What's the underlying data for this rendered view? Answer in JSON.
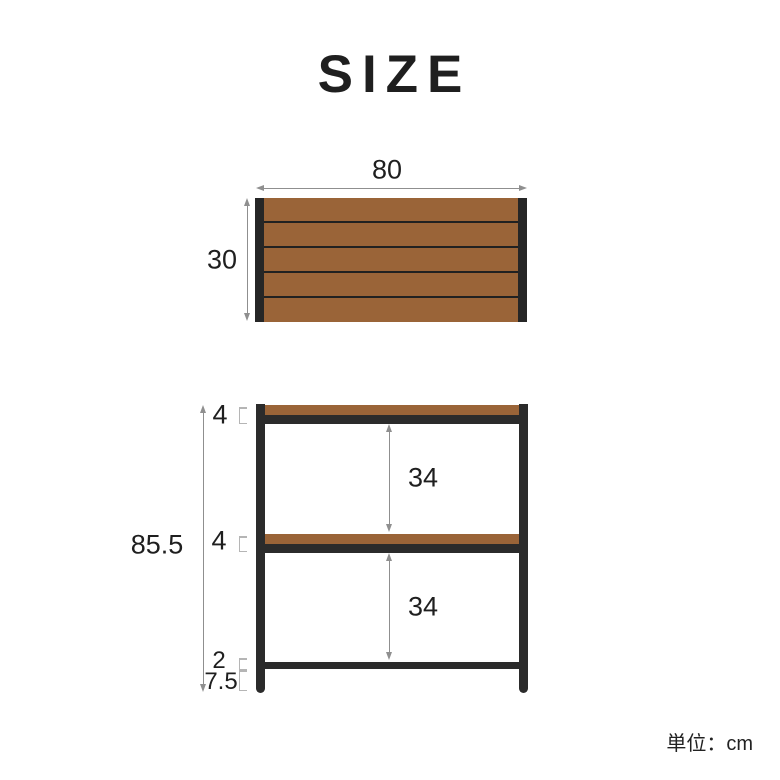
{
  "title": "SIZE",
  "unit_note": "単位：cm",
  "colors": {
    "wood_brown": "#9a6438",
    "frame_black": "#2b2b2b",
    "arrow_gray": "#8f8f8f",
    "text": "#1f1f1f"
  },
  "top_view": {
    "width_label": "80",
    "depth_label": "30",
    "plank_count": 5
  },
  "front_view": {
    "total_height_label": "85.5",
    "top_shelf_thickness_label": "4",
    "middle_shelf_thickness_label": "4",
    "upper_gap_label": "34",
    "lower_gap_label": "34",
    "bottom_bar_label": "2",
    "leg_height_label": "7.5"
  }
}
